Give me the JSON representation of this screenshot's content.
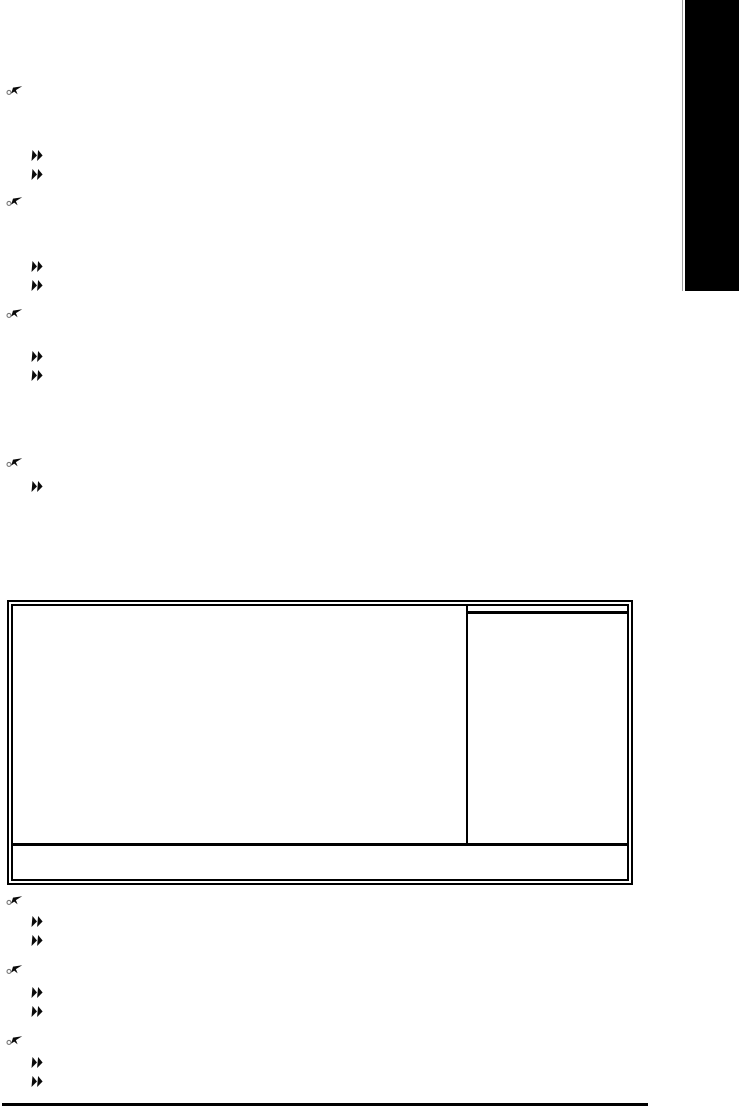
{
  "page": {
    "width": 739,
    "height": 1109,
    "background": "#ffffff"
  },
  "colors": {
    "ink": "#000000",
    "tab_black": "#000000",
    "tab_separator": "#9c9c9c"
  },
  "chapter_tab": {
    "description": "solid black chapter thumb-tab, no visible text",
    "x": 685,
    "y": 0,
    "width": 54,
    "height": 291,
    "separator": {
      "x": 682,
      "y": 0,
      "width": 1,
      "height": 291
    }
  },
  "markers": {
    "pointer_hand": {
      "icon": "pointing-hand-icon",
      "x": 6,
      "width": 17,
      "height": 12,
      "y_positions": [
        84,
        195,
        307,
        456,
        894,
        963,
        1034
      ]
    },
    "double_arrow": {
      "icon": "double-arrow-icon",
      "x": 31,
      "width": 12,
      "height": 11,
      "y_positions": [
        150,
        169,
        261,
        280,
        351,
        370,
        481,
        916,
        935,
        987,
        1006,
        1057,
        1076
      ]
    }
  },
  "bios_figure": {
    "kind": "BIOS setup screen outline (no text rendered)",
    "outer": {
      "x": 7,
      "y": 600,
      "width": 626,
      "height": 285
    },
    "help_panel_divider": {
      "x_in_inner": 453,
      "height": 240
    },
    "help_header_rule": {
      "top_in_inner": 5,
      "left_in_inner": 453
    },
    "function_bar_rule": {
      "top_in_inner": 237
    }
  },
  "footer_rule": {
    "x": 2,
    "y": 1103,
    "width": 646,
    "height": 3
  },
  "geometry": {
    "chapter-tab": {
      "left": 685,
      "top": 0,
      "width": 54,
      "height": 291
    },
    "chapter-tab-separator": {
      "left": 682,
      "top": 0,
      "width": 1,
      "height": 291
    },
    "bios-setup-screen-figure": {
      "left": 7,
      "top": 600,
      "width": 626,
      "height": 285
    },
    "page-footer-rule": {
      "left": 2,
      "top": 1103,
      "width": 646,
      "height": 3
    }
  }
}
